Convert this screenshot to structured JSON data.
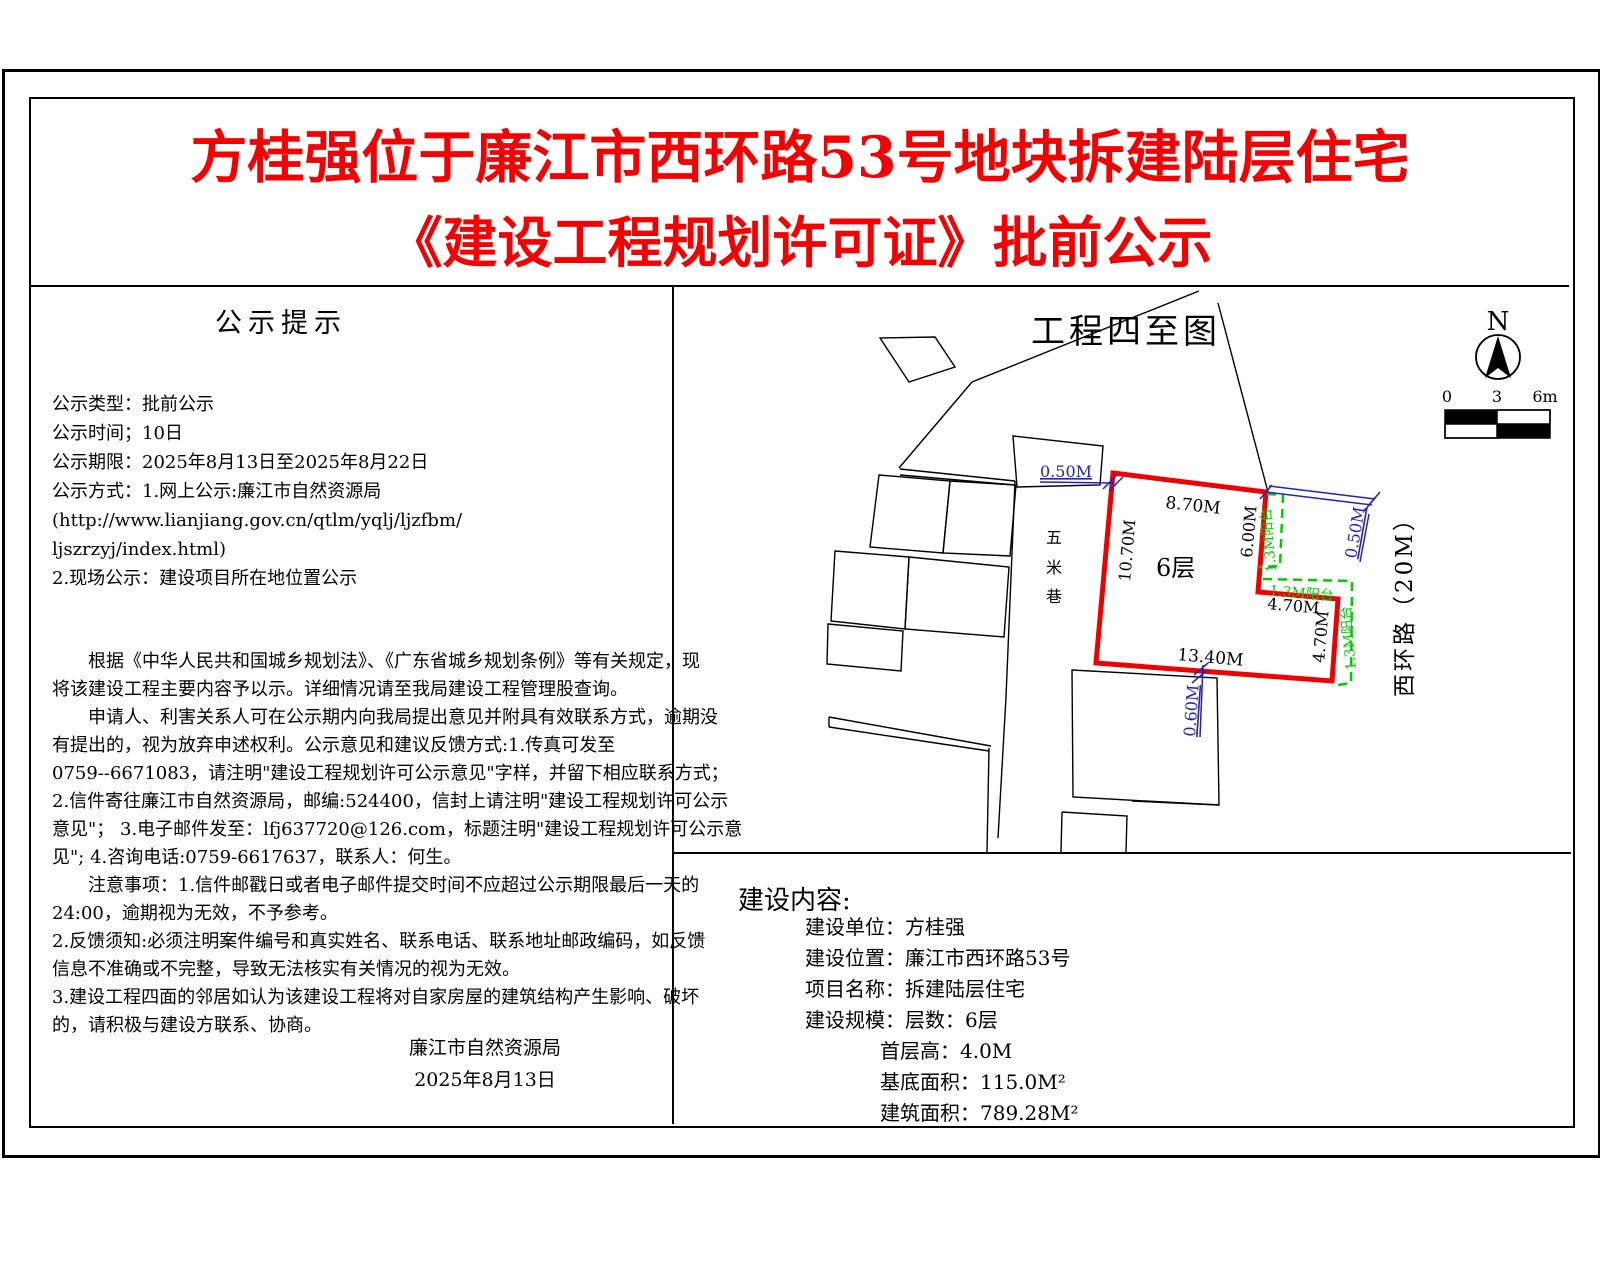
{
  "title": {
    "line1": "方桂强位于廉江市西环路53号地块拆建陆层住宅",
    "line2": "《建设工程规划许可证》批前公示"
  },
  "notice_panel": {
    "heading": "公示提示",
    "info_lines": [
      "公示类型：批前公示",
      "公示时间；10日",
      "公示期限：2025年8月13日至2025年8月22日",
      "公示方式：1.网上公示:廉江市自然资源局",
      "(http://www.lianjiang.gov.cn/qtlm/yqlj/ljzfbm/",
      " ljszrzyj/index.html)",
      "2.现场公示：建设项目所在地位置公示"
    ],
    "body_lines": [
      "　　根据《中华人民共和国城乡规划法》、《广东省城乡规划条例》等有关规定，现",
      "将该建设工程主要内容予以示。详细情况请至我局建设工程管理股查询。",
      "　　申请人、利害关系人可在公示期内向我局提出意见并附具有效联系方式，逾期没",
      "有提出的，视为放弃申述权利。公示意见和建议反馈方式:1.传真可发至",
      "0759--6671083，请注明\"建设工程规划许可公示意见\"字样，并留下相应联系方式；",
      "2.信件寄往廉江市自然资源局，邮编:524400，信封上请注明\"建设工程规划许可公示",
      "意见\"； 3.电子邮件发至：lfj637720@126.com，标题注明\"建设工程规划许可公示意",
      "见\"; 4.咨询电话:0759-6617637，联系人：何生。",
      "　　注意事项：1.信件邮戳日或者电子邮件提交时间不应超过公示期限最后一天的",
      "24:00，逾期视为无效，不予参考。",
      "2.反馈须知:必须注明案件编号和真实姓名、联系电话、联系地址邮政编码，如反馈",
      "信息不准确或不完整，导致无法核实有关情况的视为无效。",
      "3.建设工程四面的邻居如认为该建设工程将对自家房屋的建筑结构产生影响、破坏",
      "的，请积极与建设方联系、协商。"
    ],
    "signature_org": "廉江市自然资源局",
    "signature_date": "2025年8月13日"
  },
  "site_plan": {
    "title": "工程四至图",
    "north_label": "N",
    "scale_labels": [
      "0",
      "3",
      "6m"
    ],
    "floors_label": "6层",
    "lane_chars": [
      "五",
      "米",
      "巷"
    ],
    "road_label": "西环路（20M）",
    "dim_top": "8.70M",
    "dim_left": "10.70M",
    "dim_right_upper": "6.00M",
    "dim_step_h": "4.70M",
    "dim_step_v": "4.70M",
    "dim_bottom": "13.40M",
    "dim_gap_topleft": "0.50M",
    "dim_gap_right": "0.50M",
    "dim_gap_bottom": "0.60M",
    "balcony_label_1": "1.3M阳台",
    "balcony_label_2": "1.3M阳台",
    "balcony_label_3": "1.3M阳台",
    "colors": {
      "site_outline": "#ee0000",
      "balcony_green": "#00cc00",
      "dimension_blue": "#2222bb"
    }
  },
  "content_panel": {
    "heading": "建设内容:",
    "rows_a": [
      "建设单位：方桂强",
      "建设位置：廉江市西环路53号",
      "项目名称：拆建陆层住宅",
      "建设规模：层数：6层"
    ],
    "rows_b": [
      "首层高：4.0M",
      "基底面积：115.0M²",
      "建筑面积：789.28M²"
    ]
  }
}
